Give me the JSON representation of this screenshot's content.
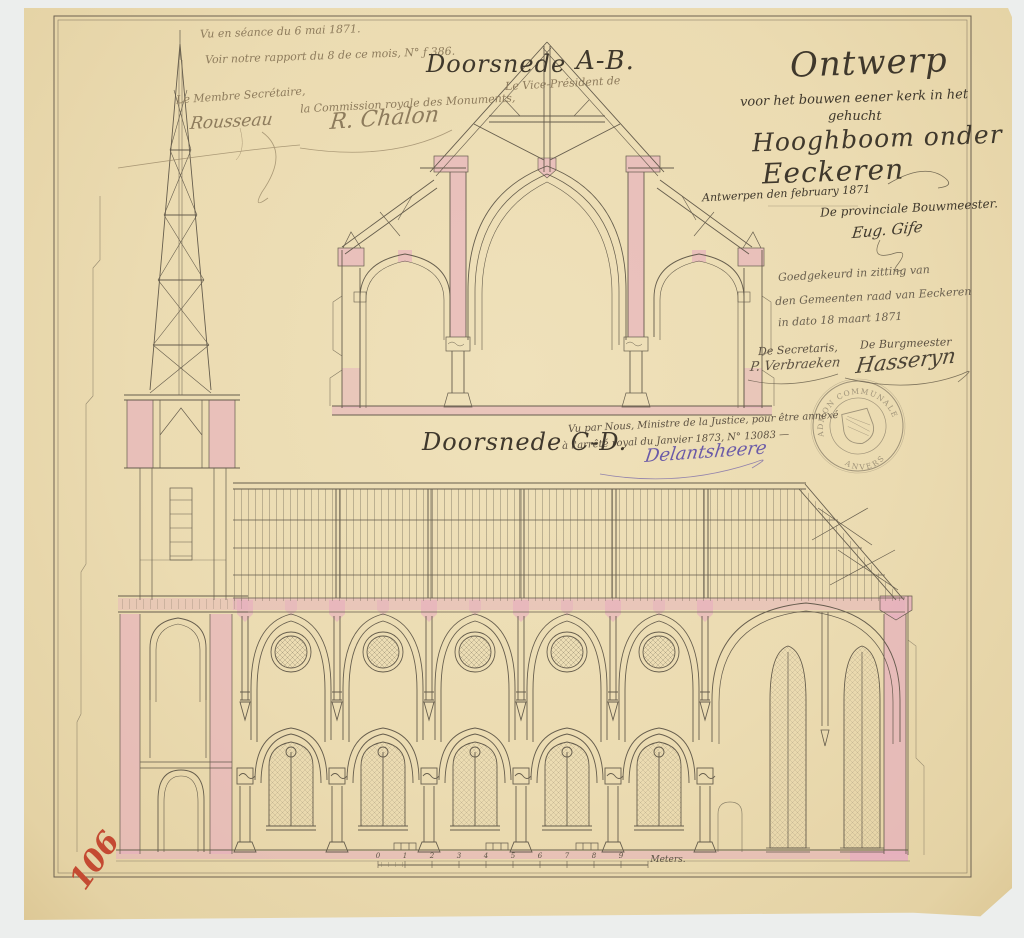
{
  "colors": {
    "paper": "#ebdbb1",
    "ink": "#56503f",
    "faded_ink": "#8d7b5c",
    "pink_wash": "#e6afbe",
    "red_number": "#c44a32",
    "violet_ink": "#6a5aa8",
    "background": "#eceeed"
  },
  "annotations": {
    "review": {
      "line1": "Vu en séance du 6 mai 1871.",
      "line2": "Voir notre rapport du 8 de ce mois, N° ƒ 386.",
      "vice_president_line1": "Le Vice-Président de",
      "vice_president_line2": "la Commission royale des Monuments,",
      "vice_president_signature": "R. Chalon",
      "secretary_title": "Le Membre Secrétaire,",
      "secretary_signature": "Rousseau"
    },
    "title_block": {
      "line1": "Ontwerp",
      "line2": "voor het bouwen eener kerk in het",
      "line3": "gehucht",
      "line4": "Hooghboom onder",
      "line5": "Eeckeren",
      "place_date": "Antwerpen den   february 1871",
      "architect_title": "De provinciale Bouwmeester.",
      "architect_signature": "Eug. Gife"
    },
    "council_approval": {
      "line1": "Goedgekeurd in zitting van",
      "line2": "den Gemeenten raad van Eeckeren",
      "line3": "in dato 18 maart 1871",
      "secretary_title": "De Secretaris,",
      "secretary_signature": "P. Verbraeken",
      "mayor_title": "De Burgmeester",
      "mayor_signature": "Hasseryn"
    },
    "ministry": {
      "line1": "Vu par Nous, Ministre de la Justice, pour être annexé",
      "line2": "à l'arrêté royal du      Janvier 1873, N° 13083 —",
      "signature": "Delantsheere"
    },
    "section_ab": {
      "label": "Doorsnede",
      "letters": "A-B."
    },
    "section_cd": {
      "label": "Doorsnede C-D."
    },
    "stamp": {
      "top": "ADMON COMMUNALE D'EECKEREN",
      "bottom": "ANVERS"
    },
    "scale": {
      "numbers": [
        "0",
        "1",
        "2",
        "3",
        "4",
        "5",
        "6",
        "7",
        "8",
        "9"
      ],
      "unit": "Meters."
    },
    "inventory_number": "106"
  }
}
